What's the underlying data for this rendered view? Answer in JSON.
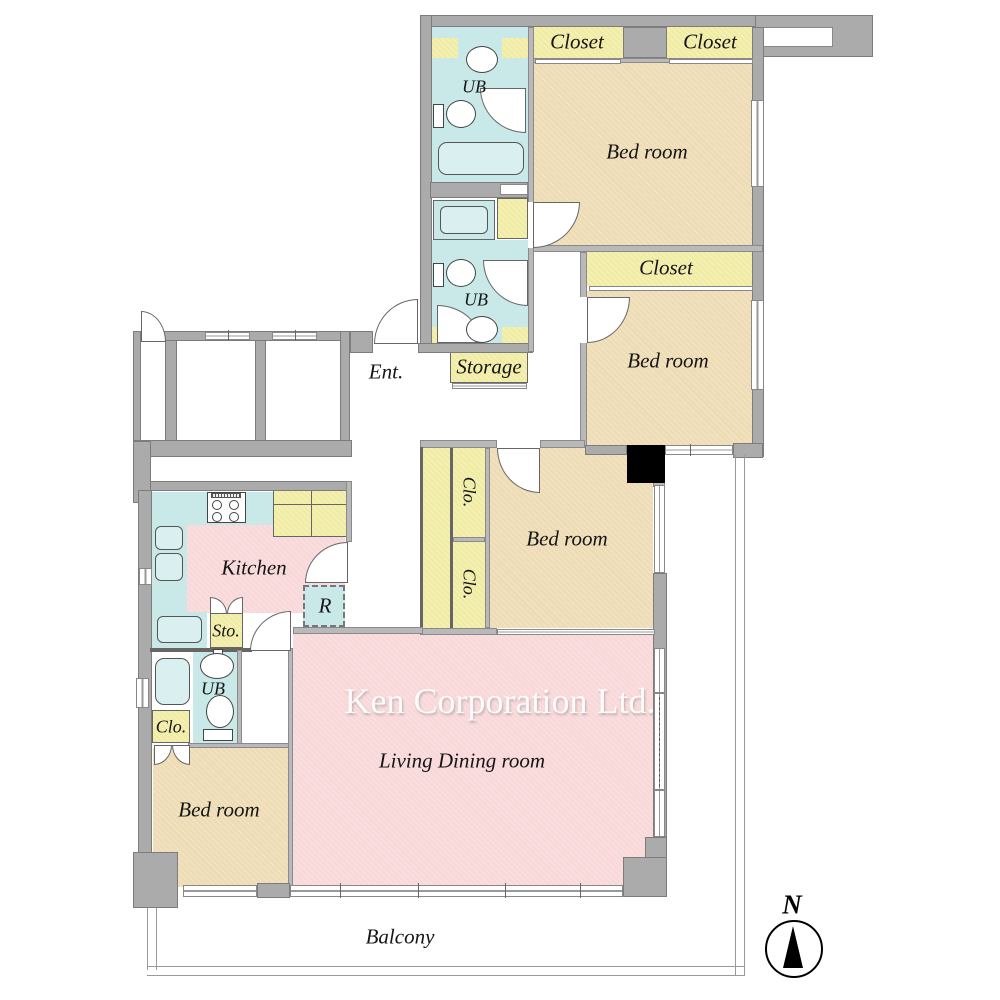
{
  "watermark": "Ken Corporation Ltd.",
  "compass_north": "N",
  "labels": {
    "closet_top_left": "Closet",
    "closet_top_right": "Closet",
    "bedroom_top": "Bed room",
    "closet_mid": "Closet",
    "bedroom_right": "Bed room",
    "ub_top": "UB",
    "ub_mid": "UB",
    "storage": "Storage",
    "entrance": "Ent.",
    "closet_small_upper": "Clo.",
    "closet_small_lower": "Clo.",
    "bedroom_center": "Bed room",
    "kitchen": "Kitchen",
    "refrigerator": "R",
    "storage_small": "Sto.",
    "ub_bottom": "UB",
    "closet_small_left": "Clo.",
    "bedroom_bottom": "Bed room",
    "living_dining": "Living Dining room",
    "balcony": "Balcony"
  },
  "colors": {
    "wall_gray": "#ababab",
    "room_tan": "#eedcb5",
    "room_pink": "#f8d8d9",
    "room_cyan": "#c9e9e9",
    "room_yellow": "#f1eca4",
    "pillar_black": "#000000",
    "watermark_gray": "#e9e9e9"
  }
}
